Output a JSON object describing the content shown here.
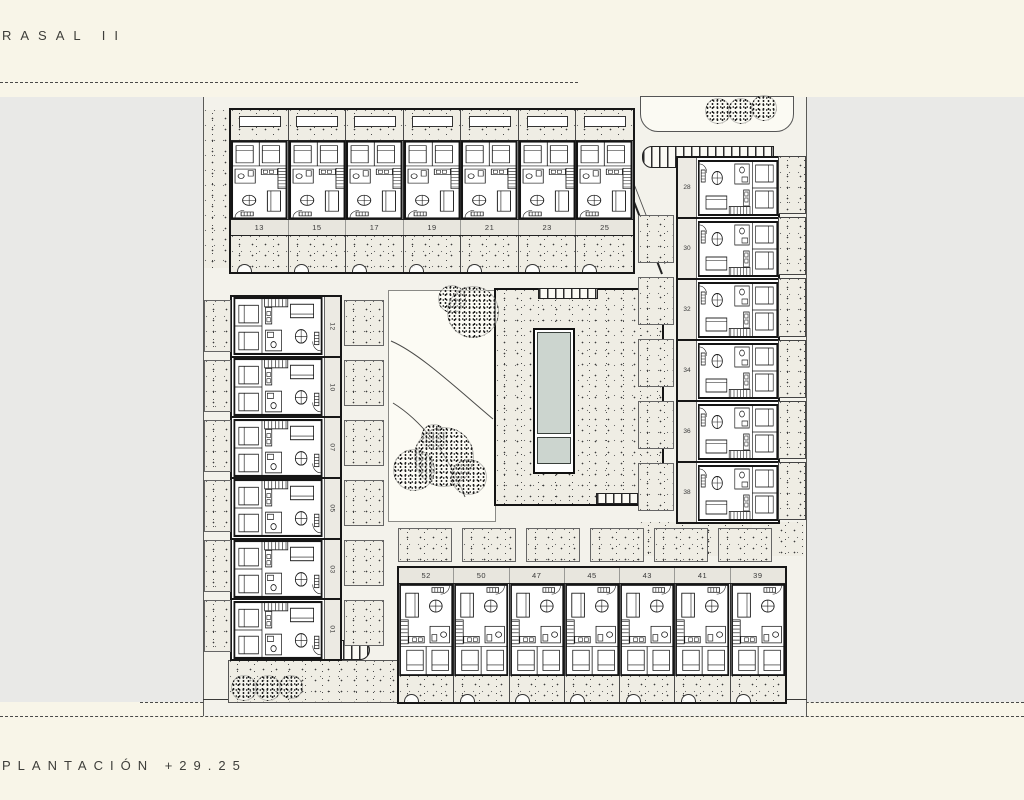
{
  "page": {
    "title": "RASAL II",
    "subtitle": "PLANTACIÓN +29.25"
  },
  "plan": {
    "top_row_units": [
      "13",
      "15",
      "17",
      "19",
      "21",
      "23",
      "25"
    ],
    "left_column_units": [
      "12",
      "10",
      "07",
      "05",
      "03",
      "01"
    ],
    "right_column_units": [
      "28",
      "30",
      "32",
      "34",
      "36",
      "38"
    ],
    "bottom_row_units": [
      "52",
      "50",
      "47",
      "45",
      "43",
      "41",
      "39"
    ]
  },
  "icons": {
    "tree": "stippled-circle",
    "ramp": "ladder-hatch",
    "pool": "rectangular-pool"
  },
  "colors": {
    "paper_cream": "#f8f5e8",
    "margin_gray": "#e9e9e7",
    "plan_bg": "#f3f2eb",
    "stipple_bg": "#efede4",
    "pool_water": "#ccd5cf",
    "line": "#1c1c1c"
  }
}
